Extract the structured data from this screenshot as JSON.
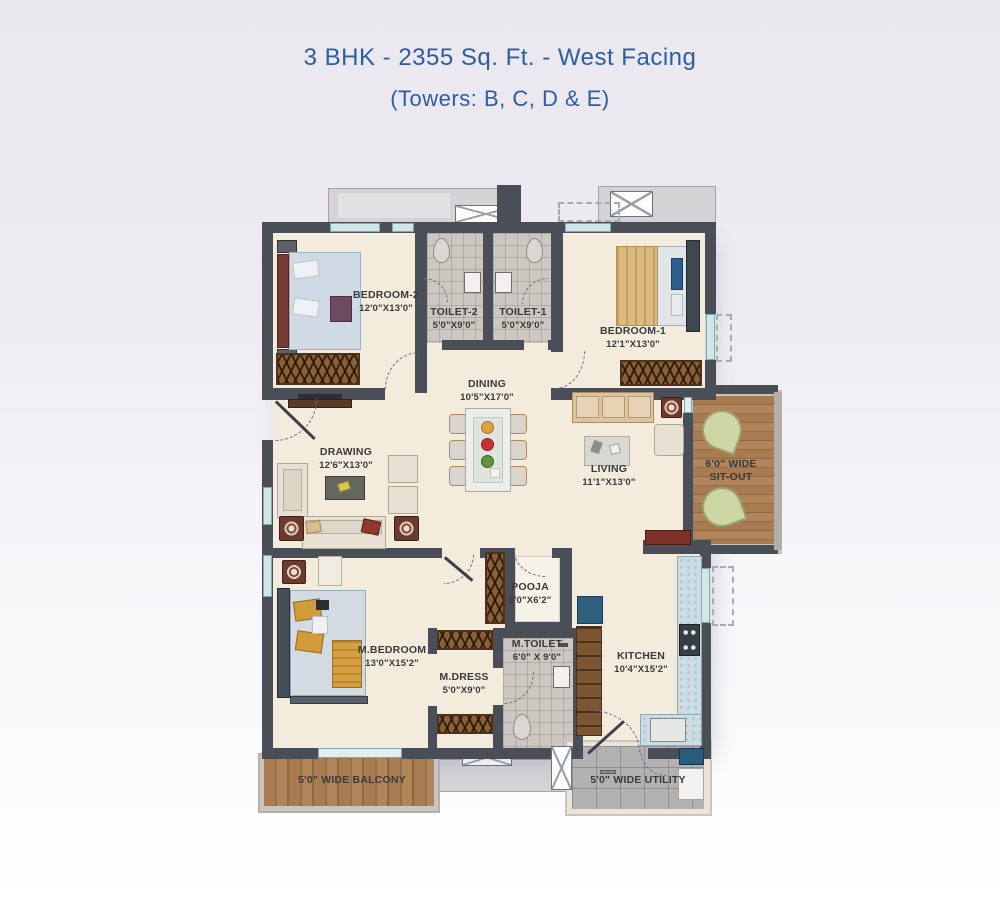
{
  "title": "3 BHK - 2355 Sq. Ft. - West Facing",
  "subtitle": "(Towers: B, C, D & E)",
  "rooms": {
    "bedroom2": {
      "name": "BEDROOM-2",
      "dim": "12'0\"X13'0\""
    },
    "toilet2": {
      "name": "TOILET-2",
      "dim": "5'0\"X9'0\""
    },
    "toilet1": {
      "name": "TOILET-1",
      "dim": "5'0\"X9'0\""
    },
    "bedroom1": {
      "name": "BEDROOM-1",
      "dim": "12'1\"X13'0\""
    },
    "dining": {
      "name": "DINING",
      "dim": "10'5\"X17'0\""
    },
    "drawing": {
      "name": "DRAWING",
      "dim": "12'6\"X13'0\""
    },
    "living": {
      "name": "LIVING",
      "dim": "11'1\"X13'0\""
    },
    "sitout": {
      "line1": "6'0\" WIDE",
      "line2": "SIT-OUT"
    },
    "mbedroom": {
      "name": "M.BEDROOM",
      "dim": "13'0\"X15'2\""
    },
    "pooja": {
      "name": "POOJA",
      "dim": "5'0\"X6'2\""
    },
    "mdress": {
      "name": "M.DRESS",
      "dim": "5'0\"X9'0\""
    },
    "mtoilet": {
      "name": "M.TOILET",
      "dim": "6'0\" X 9'0\""
    },
    "kitchen": {
      "name": "KITCHEN",
      "dim": "10'4\"X15'2\""
    },
    "balcony": {
      "name": "5'0\" WIDE BALCONY"
    },
    "utility": {
      "name": "5'0\" WIDE UTILITY"
    }
  },
  "colors": {
    "title_blue": "#2a5da6",
    "wall": "#4a4e57",
    "floor_cream": "#f3ecdd",
    "toilet_tile": "#cdc7c1",
    "wood": "#a87c50",
    "utility_tile": "#b4b1b2",
    "window_teal": "#cfe7e9",
    "label_text": "#3a3a3c"
  }
}
